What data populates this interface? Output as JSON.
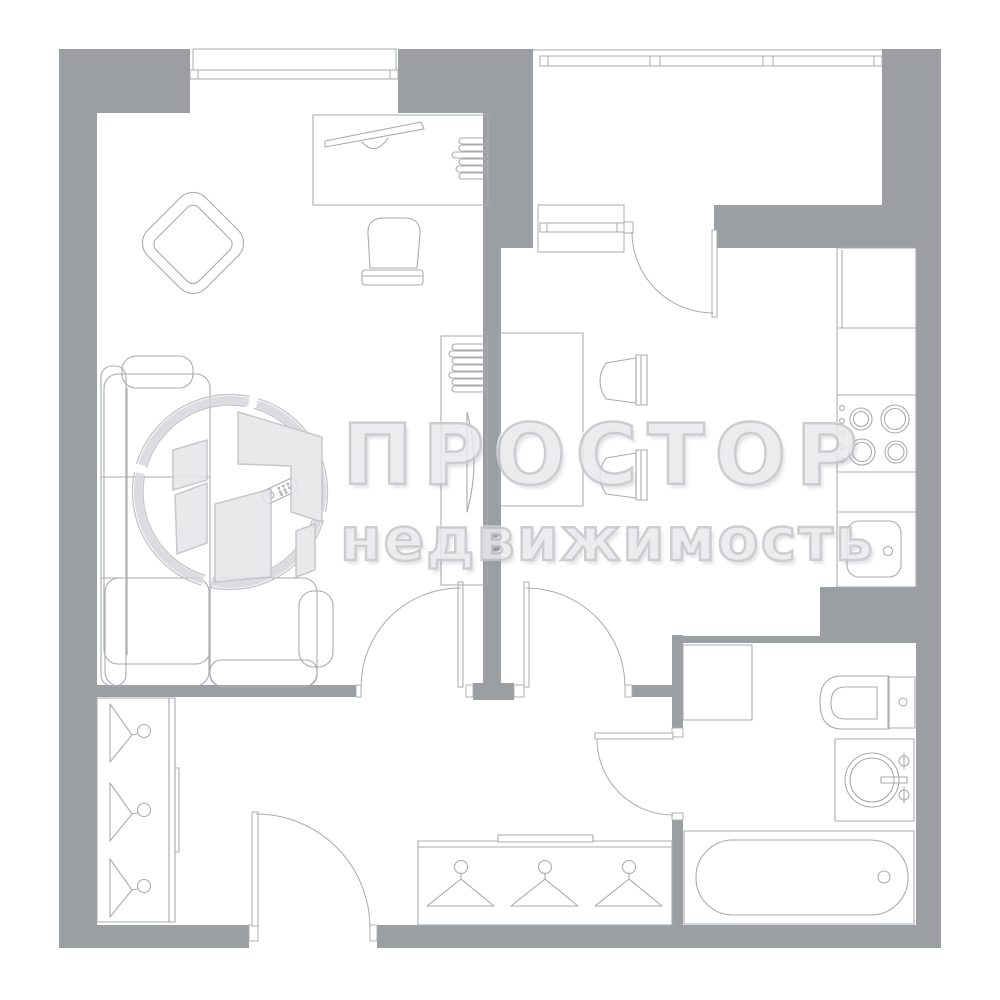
{
  "watermark": {
    "brand": "ПРОСТОР",
    "subtitle": "недвижимость"
  },
  "colors": {
    "background": "#ffffff",
    "wall": "#9b9ea3",
    "line": "#a9abb0",
    "thin_line": "#b3b5ba",
    "watermark_fill": "#e9e9ec",
    "watermark_outline": "#c5c5ca",
    "logo_ring": "#d8d8dc",
    "logo_shape_fill": "#e7e7ea",
    "logo_shape_outline": "#c0c0c5"
  },
  "plan": {
    "type": "apartment-floor-plan",
    "rooms": [
      "living-room",
      "kitchen",
      "balcony",
      "hallway",
      "bathroom"
    ],
    "furniture": [
      "sofa",
      "tv-remote",
      "armchair",
      "desk",
      "monitor",
      "shelf-stack",
      "desk-chair",
      "tv-stand",
      "radiator",
      "kitchen-table",
      "kitchen-chair",
      "fridge",
      "stove",
      "kitchen-sink",
      "duct-square",
      "toilet",
      "washing-machine",
      "bathtub",
      "coat-closet",
      "wardrobe",
      "clothes-hangers"
    ]
  }
}
